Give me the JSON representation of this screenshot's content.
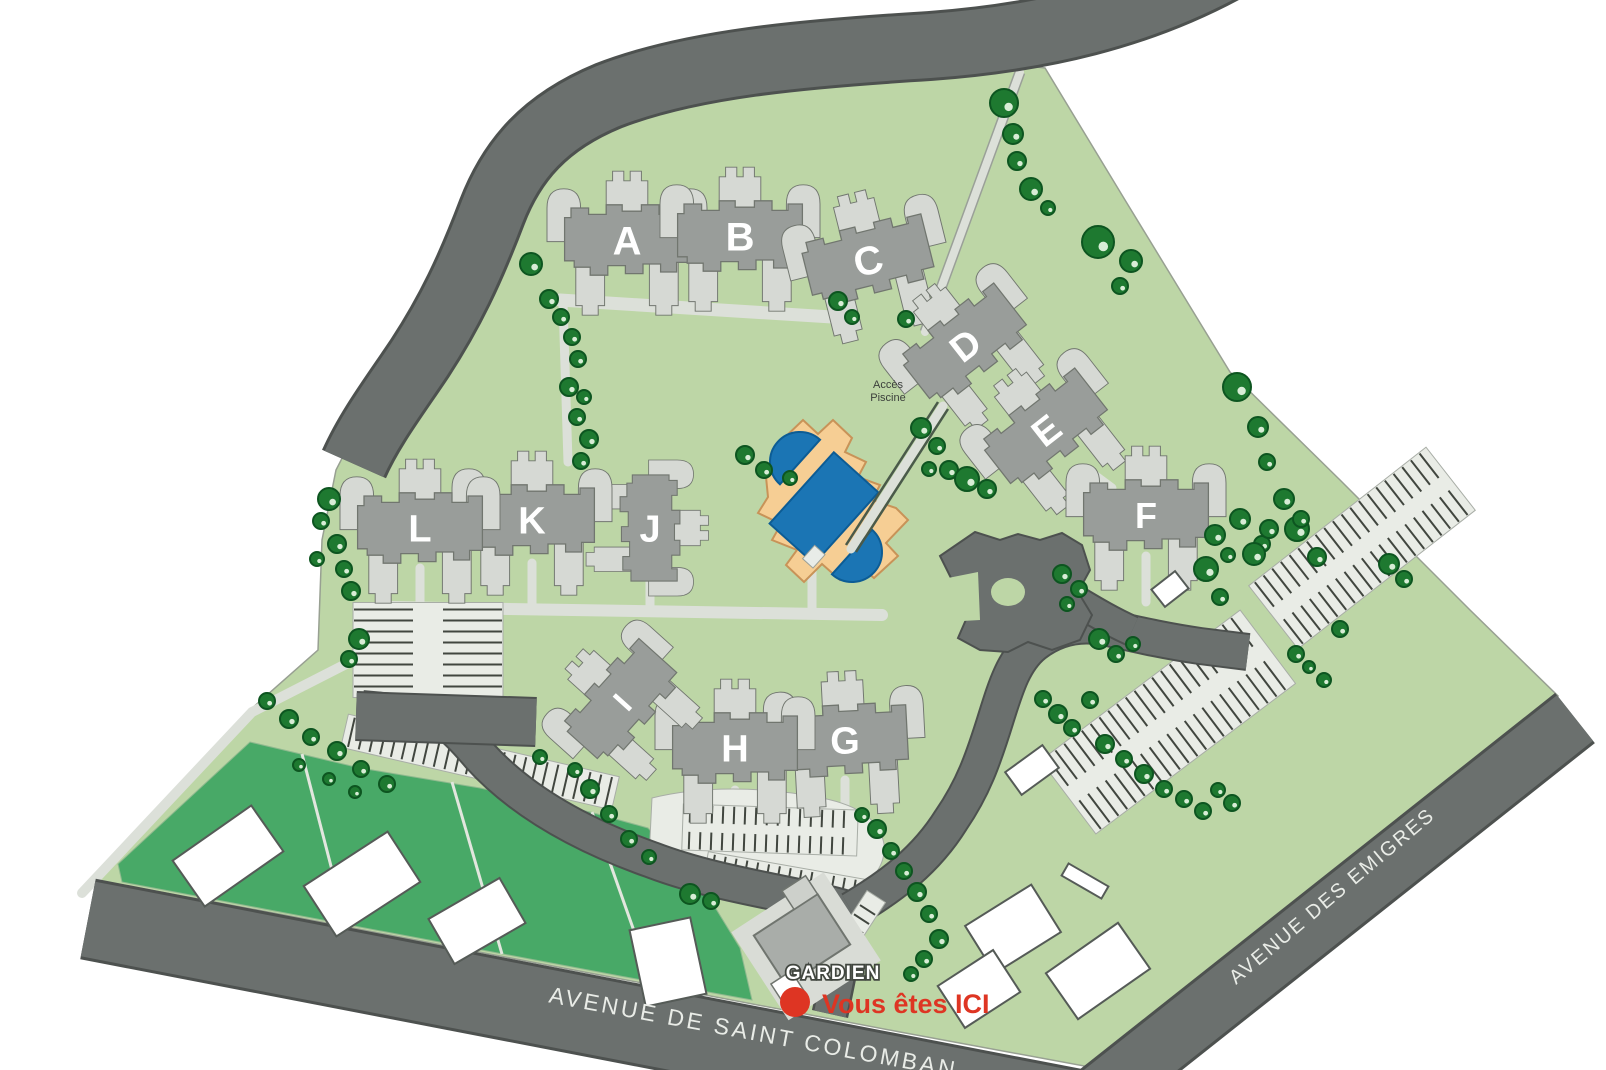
{
  "map_title": "Residence site plan",
  "palette": {
    "site_green": "#BDD6A6",
    "parcel_green": "#48A967",
    "road_gray": "#6B706E",
    "road_casing": "#4D514F",
    "building_dark": "#999D9A",
    "building_light": "#D6D9D4",
    "building_outline": "#71766F",
    "path_gray": "#DCE0D9",
    "parking_fill": "#E9ECE6",
    "parking_tick": "#41463F",
    "tree_green": "#1E7930",
    "tree_outline": "#0D5520",
    "pool_plot_orange": "#F6CE94",
    "pool_blue": "#1B75B4",
    "marker_red": "#DE3523",
    "street_text": "#E9ECE7",
    "small_text": "#3B3F3B"
  },
  "buildings": [
    {
      "label": "A"
    },
    {
      "label": "B"
    },
    {
      "label": "C"
    },
    {
      "label": "D"
    },
    {
      "label": "E"
    },
    {
      "label": "F"
    },
    {
      "label": "G"
    },
    {
      "label": "H"
    },
    {
      "label": "I"
    },
    {
      "label": "J"
    },
    {
      "label": "K"
    },
    {
      "label": "L"
    }
  ],
  "streets": [
    {
      "name": "AVENUE DE SAINT COLOMBAN"
    },
    {
      "name": "AVENUE DES EMIGRES"
    }
  ],
  "pool_access": {
    "line1": "Accès",
    "line2": "Piscine"
  },
  "caretaker": {
    "label": "GARDIEN"
  },
  "you_are_here": {
    "label": "Vous êtes ICI"
  }
}
